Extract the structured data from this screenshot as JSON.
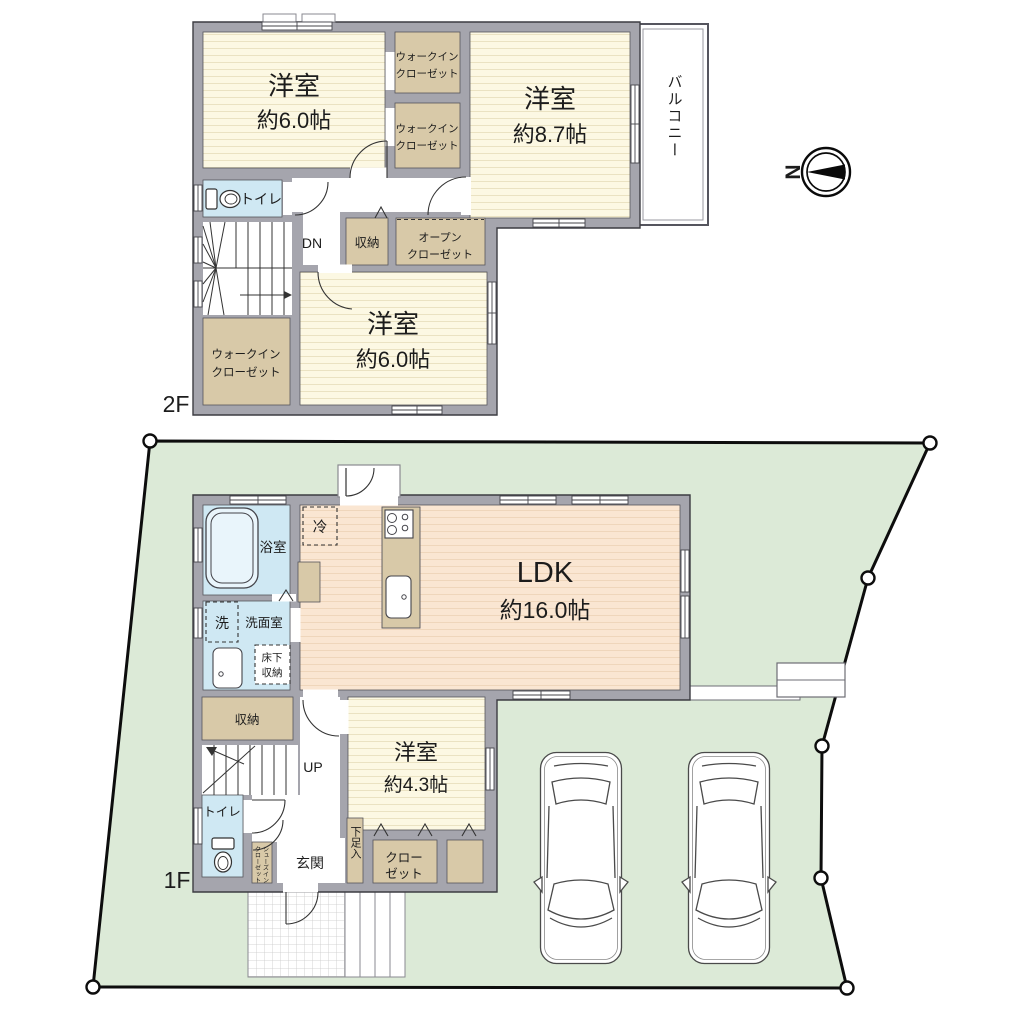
{
  "floor2": {
    "label": "2F",
    "stairs_label": "DN",
    "bedroom_a": {
      "name": "洋室",
      "size": "約6.0帖"
    },
    "bedroom_b": {
      "name": "洋室",
      "size": "約8.7帖"
    },
    "bedroom_c": {
      "name": "洋室",
      "size": "約6.0帖"
    },
    "walk_in_closet": {
      "line1": "ウォークイン",
      "line2": "クローゼット"
    },
    "open_closet": {
      "line1": "オープン",
      "line2": "クローゼット"
    },
    "storage": "収納",
    "toilet": "トイレ",
    "balcony": "バルコニー"
  },
  "floor1": {
    "label": "1F",
    "stairs_label": "UP",
    "ldk": {
      "name": "LDK",
      "size": "約16.0帖"
    },
    "bedroom": {
      "name": "洋室",
      "size": "約4.3帖"
    },
    "bathroom": "浴室",
    "washroom": "洗面室",
    "washer": "洗",
    "fridge": "冷",
    "underfloor_storage": {
      "line1": "床下",
      "line2": "収納"
    },
    "storage": "収納",
    "toilet": "トイレ",
    "entrance": "玄関",
    "shoe_cabinet": "下足入",
    "shoes_in_closet": {
      "line1": "シューズイン",
      "line2": "クローゼット"
    },
    "closet": {
      "line1": "クロー",
      "line2": "ゼット"
    }
  },
  "compass": {
    "north_label": "N"
  },
  "colors": {
    "wall": "#a5a5ad",
    "outline": "#3c3c42",
    "tatami_floor": "#fcf8e3",
    "wood_floor": "#fae6d2",
    "closet": "#d8c9a8",
    "water_room": "#cfe8f3",
    "lot_green": "#dcead7"
  }
}
